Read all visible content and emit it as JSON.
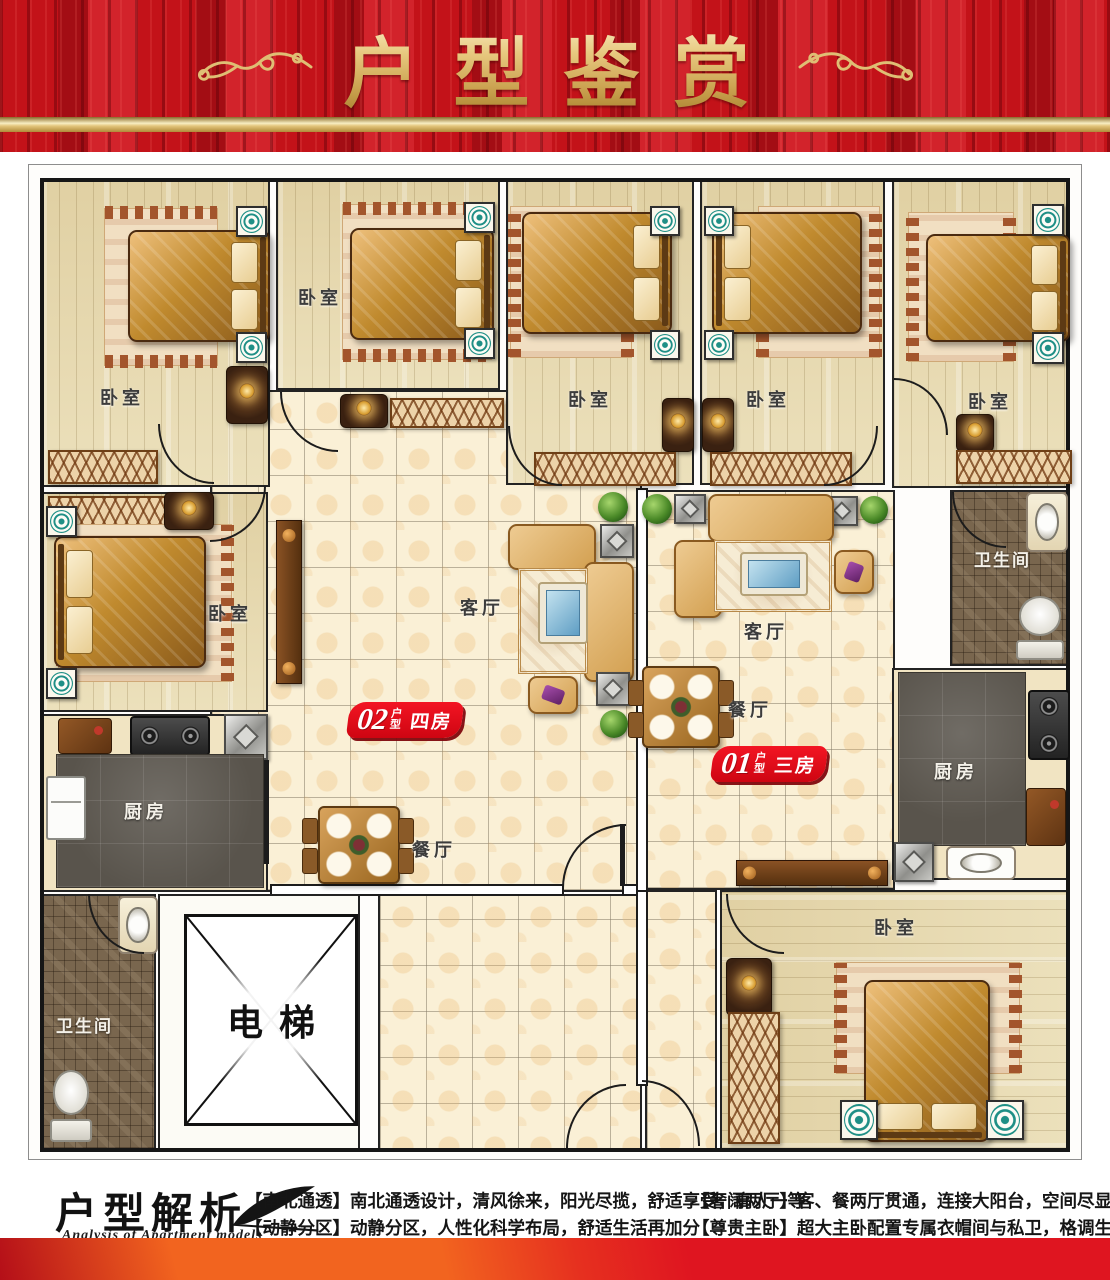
{
  "header": {
    "title": "户型鉴赏"
  },
  "plan": {
    "unit_badges": [
      {
        "number": "02",
        "type_label": "户型",
        "rooms_label": "四房"
      },
      {
        "number": "01",
        "type_label": "户型",
        "rooms_label": "三房"
      }
    ],
    "room_labels": {
      "bedroom": "卧室",
      "living": "客厅",
      "dining": "餐厅",
      "kitchen": "厨房",
      "bathroom": "卫生间",
      "elevator": "电梯"
    }
  },
  "footer": {
    "heading": "户型解析",
    "subheading": "Analysis of Apartment models",
    "features": [
      {
        "tag": "【南北通透】",
        "text": "南北通透设计，清风徐来，阳光尽揽，舒适享受，高人一等"
      },
      {
        "tag": "【动静分区】",
        "text": "动静分区，人性化科学布局，舒适生活再加分"
      },
      {
        "tag": "【奢阔两厅】",
        "text": "客、餐两厅贯通，连接大阳台，空间尽显豪华大气"
      },
      {
        "tag": "【尊贵主卧】",
        "text": "超大主卧配置专属衣帽间与私卫，格调生活再升级"
      }
    ]
  },
  "icons": {
    "header_ornament": "swirl-flourish-icon",
    "footer_feather": "quill-feather-icon",
    "elevator_cross": "elevator-x-icon"
  },
  "colors": {
    "header_red": "#c31219",
    "gold": "#d9b46a",
    "badge_red": "#e30613",
    "band_orange": "#f2641f",
    "band_red": "#df1520"
  }
}
